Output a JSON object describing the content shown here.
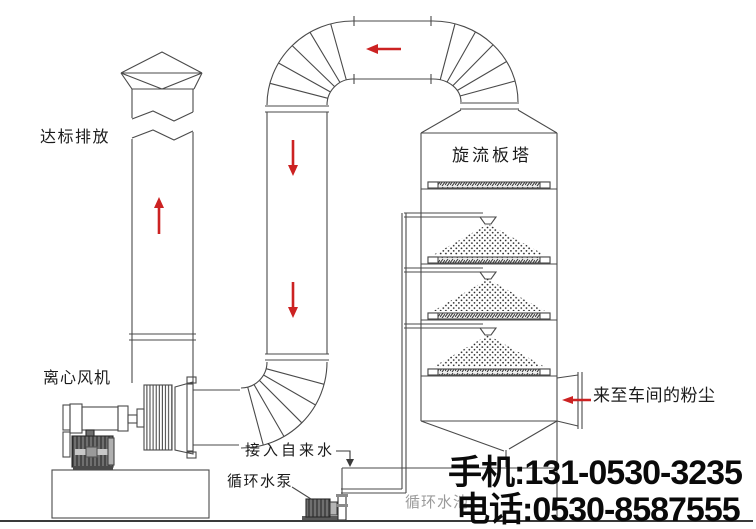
{
  "diagram": {
    "labels": {
      "emission": "达标排放",
      "fan": "离心风机",
      "tower": "旋流板塔",
      "dust_inlet": "来至车间的粉尘",
      "tap_water": "接入自来水",
      "pump": "循环水泵",
      "pool": "循环水池"
    },
    "contact": {
      "mobile": "手机:131-0530-3235",
      "phone": "电话:0530-8587555"
    },
    "colors": {
      "line": "#4a4a4a",
      "arrow_red": "#cc2222",
      "label_text": "#1b1b1b",
      "pool_label_gray": "#9a9a9a",
      "contact_text": "#0a0a0a",
      "motor_gray": "#6e6e6e",
      "background": "#ffffff"
    }
  }
}
